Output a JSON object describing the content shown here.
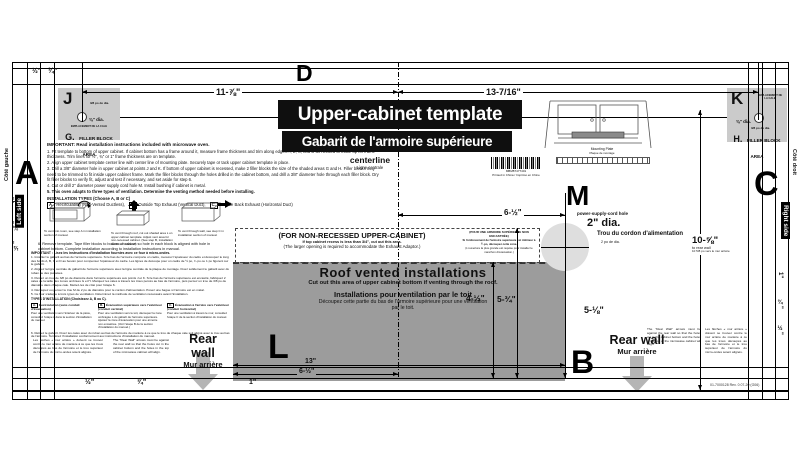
{
  "title": {
    "en": "Upper-cabinet template",
    "fr": "Gabarit de l'armoire supérieure"
  },
  "centerline_label": {
    "en": "centerline",
    "fr": "Ligne centrale"
  },
  "barcode": {
    "number": "MBM87477401",
    "printed": "Printed in China / Imprimé en Chine"
  },
  "mounting_plate": {
    "en": "Mounting Plate",
    "fr": "Plaque de montage"
  },
  "edges": {
    "top_letter": "D",
    "left_letter": "A",
    "right_letter": "C",
    "bottom_letter": "B"
  },
  "side_labels": {
    "left_en": "Left side",
    "left_fr": "Côté gauche",
    "right_en": "Right side",
    "right_fr": "Côté droit"
  },
  "trim": {
    "top": [
      "½\"",
      "¾\""
    ],
    "bottom": [
      "½\"",
      "¾\"",
      "1\""
    ],
    "left": [
      "1\"",
      "¾\"",
      "½\""
    ],
    "right": [
      "1\"",
      "¾\"",
      "½\""
    ]
  },
  "dims": {
    "top_left": "11-⅞\"",
    "top_right": "13-7/16\"",
    "center_to_hole": "6-½\"",
    "roof_left": "4-½\"",
    "roof_right": "5-¾\"",
    "hole_to_rear": "5-⅛\"",
    "bottom_full": "13\"",
    "bottom_half": "6-½\"",
    "to_rear_value": "10-⅝\"",
    "to_rear_en": "to rear wall",
    "to_rear_fr": "10 5/8 po vers le mur arrière"
  },
  "j_block": {
    "letter": "J",
    "dia_fr": "3/8 po de dia.",
    "dia_en": "⅜\" dia.",
    "cale": "EMPLACEMENT DE LA CALE",
    "area_letter": "G.",
    "area_text": "FILLER BLOCK AREA"
  },
  "k_block": {
    "letter": "K",
    "dia_fr": "3/8 po de dia.",
    "dia_en": "⅜\" dia.",
    "cale": "EMPLACEMENT DE LA CALE",
    "area_letter": "H.",
    "area_text": "FILLER BLOCK AREA"
  },
  "power_hole": {
    "letter": "M",
    "label": "power-supply-cord hole",
    "dia_en": "2\" dia.",
    "label_fr": "Trou du cordon d'alimentation",
    "dia_fr": "2 po de dia."
  },
  "non_recessed": {
    "en_title": "(FOR NON-RECESSED UPPER-CABINET)",
    "en_line1": "If top cabinet recess is less than 3/4\", cut out this area.",
    "en_line2": "(The larger opening is required to accommodate the Exhaust Adaptor.)",
    "fr_title": "(POUR UNE ARMOIRE SUPÉRIEURE NON ENCASTRÉE)",
    "fr_line1": "Si l'enfoncement de l'armoire supérieure est inférieur à ¾ po, découpez cette zone.",
    "fr_line2": "(L'ouverture la plus grande est requise pour installer le manchon d'évacuation.)"
  },
  "roof_vent": {
    "letter": "L",
    "en_title": "Roof vented  installations",
    "en_sub": "Cut out this area of upper cabinet bottom if venting through the roof.",
    "fr_title": "Installations pour ventilation par le toit",
    "fr_sub": "Découpez cette partie du bas de l'armoire supérieure pour une ventilation par le toit."
  },
  "rear_wall": {
    "en": "Rear wall",
    "fr": "Mur arrière"
  },
  "rear_note": {
    "en": "The \"Rear Wall\" arrows must be against the rear wall so that the holes cut in the cabinet bottom and the holes in the top of the microwave cabinet will align.",
    "fr": "Les flèches « mur arrière » doivent se trouver contre le mur arrière de manière à ce que les trous découpés au bas de l'armoire et le trou supérieur de l'armoire du micro-ondes soient alignés."
  },
  "instructions": {
    "heading": "IMPORTANT:  Read installation instructions included with microwave oven.",
    "steps": [
      "1. Fit template to bottom of upper cabinet. If cabinet bottom has a frame around it, measure frame thickness and trim along edges A, B, C, and D as needed to make up for frame thickness. Trim lines for ½\", ¾\" or 1\" frame thickness are on template.",
      "2. Align upper cabinet template center line with center line of mounting plate. Securely tape or tack upper cabinet template in place.",
      "3. Drill a 3/8\" diameter hole in upper cabinet at points J and K. If bottom of upper cabinet is recessed, make 2 filler blocks the size of the shaded areas G and H. Filler blocks may need to be trimmed to fit inside upper cabinet frame. Mark the filler blocks through the holes drilled in the cabinet bottom, and drill a 3/8\" diameter hole through each filler block. Dry fit filler blocks to verify fit, adjust and test if necessary, and set aside for step 6.",
      "4. Cut or drill 2\" diameter power supply cord hole M. Install bushing if cabinet is metal.",
      "5. This oven adapts to three types of ventilation. Determine the venting method needed before installing."
    ],
    "types_heading": "INSTALLATION TYPES (Choose A, B or C)",
    "types": [
      {
        "key": "A.",
        "label": "Recirculating (Non-Vented Ductless),"
      },
      {
        "key": "B.",
        "label": "Outside Top Exhaust (Vertical Duct),"
      },
      {
        "key": "C.",
        "label": "Outside Back Exhaust (Horizontal Duct)"
      }
    ],
    "captions": [
      "To vent into room, see step A in installation section of manual.",
      "To vent through roof, cut out shaded area L on upper cabinet template. Adjust vent area for non-recessed cabinet. (See step B, installation section of manual.)",
      "To vent through wall, see step C in installation section of manual."
    ],
    "step6": "6. Remove template. Tape filler blocks to bottom of cabinet so hole in each block is aligned with hole in cabinet bottom. Complete installation according to installation instructions in manual.",
    "fr_heading": "IMPORTANT : Lisez les instructions d'installation fournies avec ce four à micro-ondes.",
    "fr_steps": [
      "1. Installez le gabarit au bas de l'armoire supérieure. Si le bas de l'armoire comporte un cadre, mesurez l'épaisseur du cadre et découpez le long des bords A, B, C et D au besoin pour compenser l'épaisseur du cadre. Les lignes de découpe pour un cadre de ½ po, ¾ po ou 1 po figurent sur le gabarit.",
      "2. Alignez la ligne centrale du gabarit de l'armoire supérieure avec la ligne centrale de la plaque de montage. Fixez solidement le gabarit avec du ruban ou des punaises.",
      "3. Percez un trou de 3/8 po de diamètre dans l'armoire supérieure aux points J et K. Si le bas de l'armoire supérieure est encastré, fabriquez 2 cales de la taille des zones ombrées G et H. Marquez les cales à travers les trous percés au bas de l'armoire, puis percez un trou de 3/8 po de diamètre dans chaque cale. Mettez-les de côté pour l'étape 6.",
      "4. Découpez ou percez le trou M de 2 po de diamètre pour le cordon d'alimentation. Posez une bague si l'armoire est en métal.",
      "5. Ce four s'adapte à trois types de ventilation. Déterminez la méthode de ventilation nécessaire avant l'installation."
    ],
    "fr_types_heading": "TYPES D'INSTALLATION (Choisissez A, B ou C).",
    "fr_types": [
      {
        "key": "A.",
        "title": "Recirculation (sans conduit d'évacuation)",
        "body": "Pour une ventilation vers l'intérieur de la pièce, consultez l'étape A dans la section d'installation du manuel."
      },
      {
        "key": "B.",
        "title": "Évacuation supérieure vers l'extérieur (conduit vertical)",
        "body": "Pour une ventilation vers le toit, découpez la zone ombragée L du gabarit de l'armoire supérieure. Ajustez la zone d'évacuation pour une armoire non encastrée. (Voir l'étape B de la section d'installation du manuel.)"
      },
      {
        "key": "C.",
        "title": "Évacuation à l'arrière vers l'extérieur (conduit horizontal)",
        "body": "Pour une ventilation à travers le mur, consultez l'étape C de la section d'installation du manuel."
      }
    ],
    "fr_step6": "6. Retirez le gabarit. Fixez les cales avec du ruban au bas de l'armoire de manière à ce que le trou de chaque cale soit aligné avec le trou au bas de l'armoire. Terminez l'installation conformément aux instructions d'installation du manuel."
  },
  "footer": {
    "part": "01-7000128   Rev. 0   07-20   (G06)"
  }
}
